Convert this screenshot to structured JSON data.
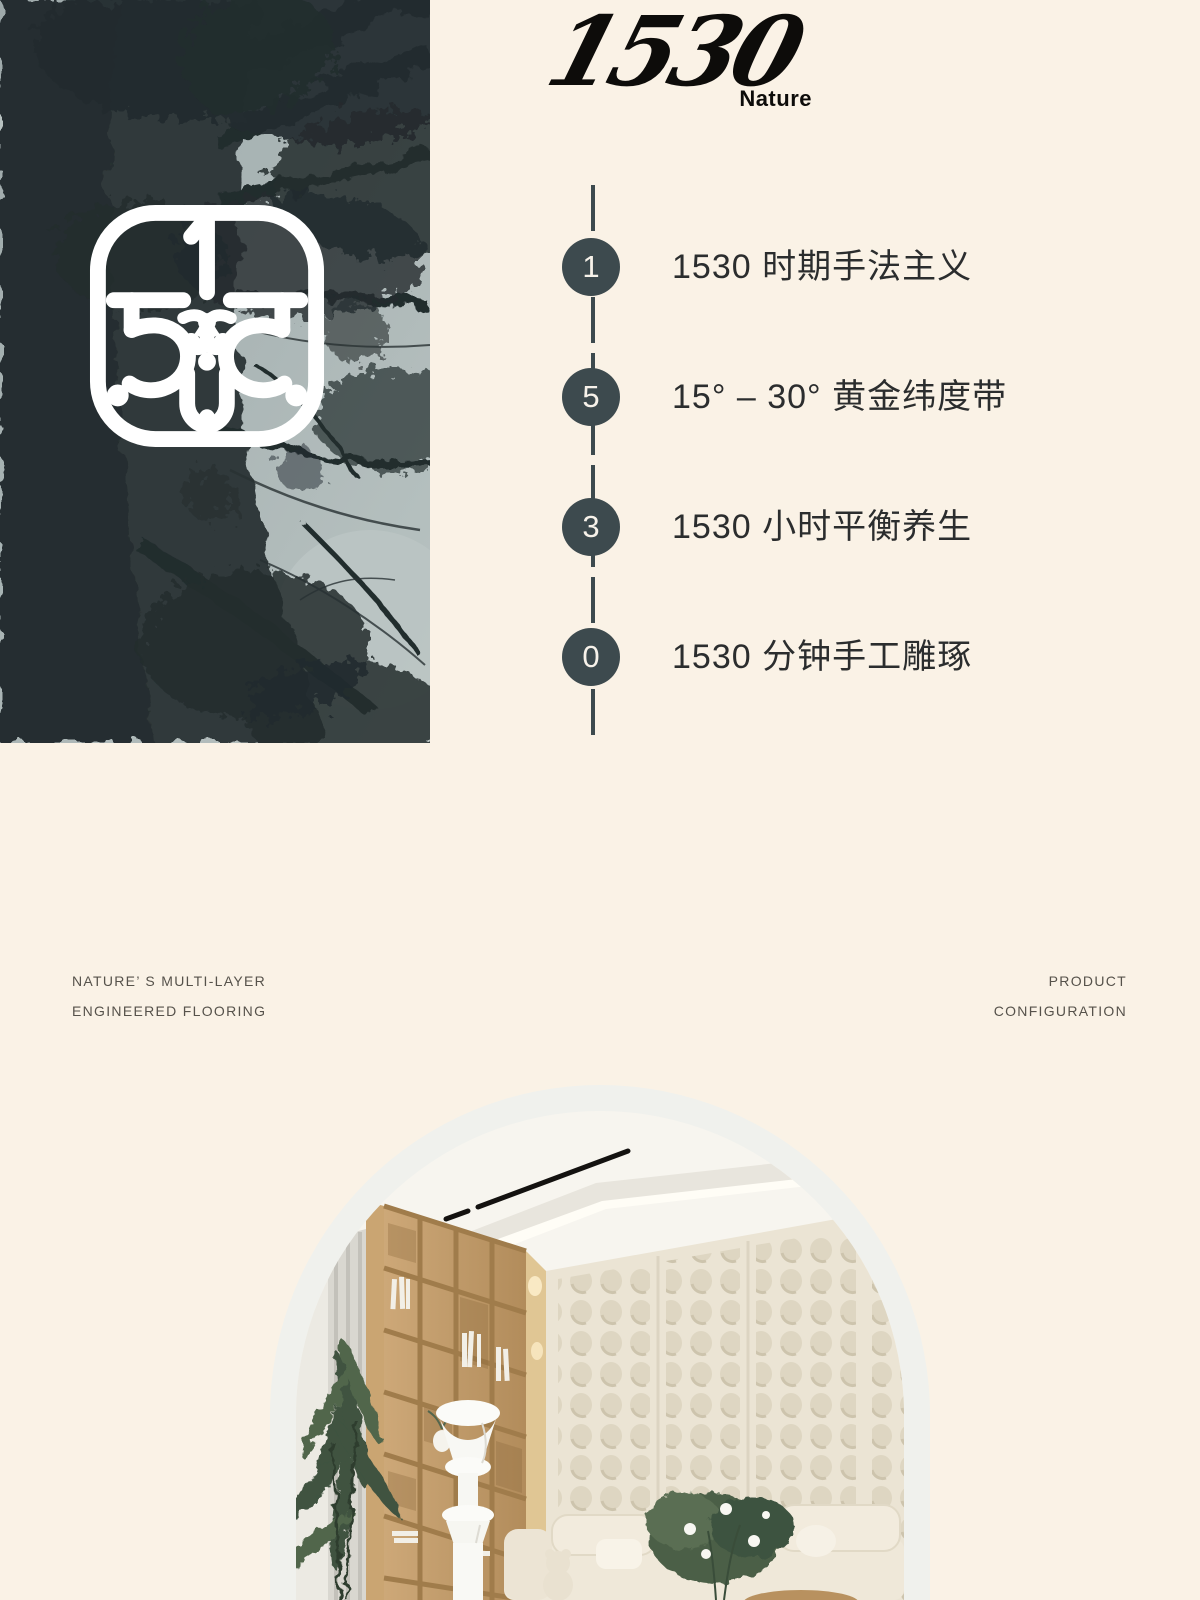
{
  "colors": {
    "page_bg": "#faf2e6",
    "timeline_accent": "#3d4a4e",
    "ink": "#2b2d2e",
    "footer_text": "#56524b",
    "logo_black": "#0d0c0a",
    "photo_sky": "#b5c0c1",
    "photo_foliage": "#272f31",
    "wood": "#c2996a",
    "dotted_wall": "#ebe4d4",
    "arch_ring": "#f0f1ed"
  },
  "brand": {
    "wordmark": "1530",
    "submark": "Nature"
  },
  "timeline": {
    "items": [
      {
        "number": "1",
        "label": "1530 时期手法主义"
      },
      {
        "number": "5",
        "label": "15° – 30° 黄金纬度带"
      },
      {
        "number": "3",
        "label": "1530 小时平衡养生"
      },
      {
        "number": "0",
        "label": "1530 分钟手工雕琢"
      }
    ]
  },
  "section": {
    "left_line1": "NATURE’ S MULTI-LAYER",
    "left_line2": "ENGINEERED FLOORING",
    "right_line1": "PRODUCT",
    "right_line2": "CONFIGURATION"
  },
  "images": {
    "tree_photo": "black-and-white upward view of tall tree canopy",
    "monogram": "white ornamental 1530 monogram in rounded square",
    "interior_photo": "arched photo of cream interior with wooden bookshelf, dotted wall panel and sofa"
  }
}
